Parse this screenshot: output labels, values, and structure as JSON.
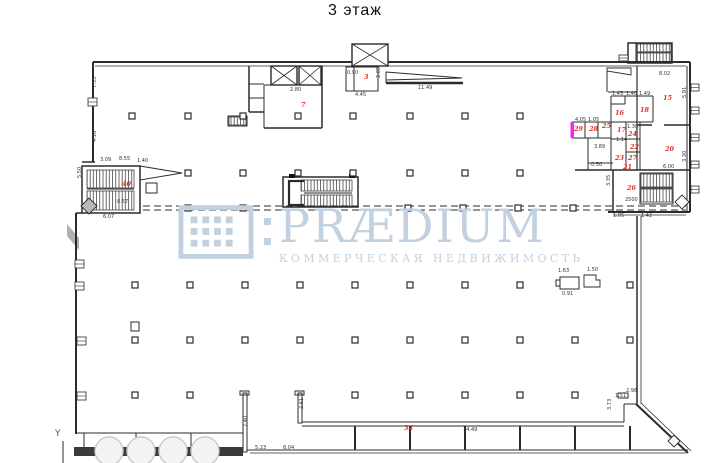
{
  "title": "3 этаж",
  "watermark": {
    "brand": "PRÆDIUM",
    "subtitle": "КОММЕРЧЕСКАЯ НЕДВИЖИМОСТЬ",
    "color": "#c2d1e0"
  },
  "plan": {
    "colors": {
      "line": "#2b2b2b",
      "red": "#e03028",
      "pink": "#ee2ee2",
      "gray": "#b0b0b0",
      "circle_fill": "#f3f3f3",
      "circle_stroke": "#c9c9c9",
      "bar": "#3a3a3a"
    },
    "room_labels": [
      {
        "t": "3",
        "x": 364,
        "y": 79
      },
      {
        "t": "7",
        "x": 301,
        "y": 107
      },
      {
        "t": "40",
        "x": 122,
        "y": 186
      },
      {
        "t": "15",
        "x": 663,
        "y": 100
      },
      {
        "t": "16",
        "x": 615,
        "y": 115
      },
      {
        "t": "18",
        "x": 640,
        "y": 112
      },
      {
        "t": "17",
        "x": 617,
        "y": 132
      },
      {
        "t": "24",
        "x": 628,
        "y": 136
      },
      {
        "t": "22",
        "x": 630,
        "y": 149
      },
      {
        "t": "23",
        "x": 615,
        "y": 160
      },
      {
        "t": "27",
        "x": 628,
        "y": 160
      },
      {
        "t": "21",
        "x": 623,
        "y": 169
      },
      {
        "t": "25",
        "x": 602,
        "y": 128
      },
      {
        "t": "28",
        "x": 589,
        "y": 131
      },
      {
        "t": "29",
        "x": 574,
        "y": 131
      },
      {
        "t": "20",
        "x": 665,
        "y": 151
      },
      {
        "t": "26",
        "x": 627,
        "y": 190
      },
      {
        "t": "34",
        "x": 404,
        "y": 430
      }
    ],
    "dims": [
      {
        "t": "7.35",
        "x": 96,
        "y": 88,
        "r": 1
      },
      {
        "t": "4.16",
        "x": 96,
        "y": 142,
        "r": 1
      },
      {
        "t": "3.09",
        "x": 100,
        "y": 161
      },
      {
        "t": "8.55",
        "x": 119,
        "y": 160
      },
      {
        "t": "1.40",
        "x": 137,
        "y": 162
      },
      {
        "t": "5.50",
        "x": 81,
        "y": 178,
        "r": 1
      },
      {
        "t": "8.57",
        "x": 117,
        "y": 203
      },
      {
        "t": "6.07",
        "x": 103,
        "y": 218
      },
      {
        "t": "2.80",
        "x": 290,
        "y": 91
      },
      {
        "t": "0.90",
        "x": 347,
        "y": 74
      },
      {
        "t": "2.05",
        "x": 380,
        "y": 78,
        "r": 1
      },
      {
        "t": "4.45",
        "x": 355,
        "y": 96
      },
      {
        "t": "11.49",
        "x": 418,
        "y": 89
      },
      {
        "t": "8.02",
        "x": 659,
        "y": 75
      },
      {
        "t": "5.91",
        "x": 686,
        "y": 98,
        "r": 1
      },
      {
        "t": "6.00",
        "x": 663,
        "y": 168
      },
      {
        "t": "3.30",
        "x": 686,
        "y": 162,
        "r": 1
      },
      {
        "t": "4.05",
        "x": 575,
        "y": 121
      },
      {
        "t": "1.05",
        "x": 588,
        "y": 121
      },
      {
        "t": "1.43",
        "x": 612,
        "y": 95
      },
      {
        "t": "1.40",
        "x": 626,
        "y": 95
      },
      {
        "t": "1.49",
        "x": 639,
        "y": 95
      },
      {
        "t": "3.89",
        "x": 594,
        "y": 148
      },
      {
        "t": "1.14",
        "x": 616,
        "y": 141
      },
      {
        "t": "1.30",
        "x": 627,
        "y": 128
      },
      {
        "t": "0.50",
        "x": 591,
        "y": 166
      },
      {
        "t": "3.35",
        "x": 610,
        "y": 186,
        "r": 1
      },
      {
        "t": "2500",
        "x": 625,
        "y": 201
      },
      {
        "t": "1.05",
        "x": 613,
        "y": 217
      },
      {
        "t": "1.42",
        "x": 641,
        "y": 217
      },
      {
        "t": "1.63",
        "x": 558,
        "y": 272
      },
      {
        "t": "1.50",
        "x": 587,
        "y": 271
      },
      {
        "t": "0.91",
        "x": 562,
        "y": 295
      },
      {
        "t": "7.40",
        "x": 247,
        "y": 427,
        "r": 1
      },
      {
        "t": "2.61",
        "x": 303,
        "y": 409,
        "r": 1
      },
      {
        "t": "5.23",
        "x": 255,
        "y": 449
      },
      {
        "t": "8.04",
        "x": 283,
        "y": 449
      },
      {
        "t": "14.49",
        "x": 463,
        "y": 431
      },
      {
        "t": "1.51",
        "x": 615,
        "y": 397
      },
      {
        "t": "2.98",
        "x": 626,
        "y": 392
      },
      {
        "t": "3.73",
        "x": 611,
        "y": 410,
        "r": 1
      }
    ],
    "texts": [
      {
        "t": "Y",
        "x": 55,
        "y": 436
      }
    ],
    "geometry": {
      "walls": [
        [
          93,
          62,
          690,
          62,
          2
        ],
        [
          95,
          66,
          686,
          66,
          0.8
        ],
        [
          93,
          62,
          93,
          162,
          2
        ],
        [
          687,
          66,
          687,
          212,
          1
        ],
        [
          690,
          62,
          690,
          212,
          2
        ],
        [
          82,
          162,
          95,
          162,
          1.5
        ],
        [
          76,
          213,
          76,
          434,
          2
        ],
        [
          76,
          213,
          82,
          213,
          1.5
        ],
        [
          76,
          433,
          243,
          433,
          1
        ],
        [
          84,
          433,
          84,
          447,
          1
        ],
        [
          136,
          433,
          136,
          447,
          1
        ],
        [
          191,
          433,
          191,
          447,
          1
        ],
        [
          63,
          441,
          63,
          463,
          1
        ],
        [
          608,
          212,
          690,
          212,
          2
        ],
        [
          613,
          215,
          686,
          215,
          0.8
        ],
        [
          637,
          216,
          637,
          404,
          1.5
        ],
        [
          641,
          216,
          641,
          404,
          0.8
        ],
        [
          636,
          404,
          688,
          453,
          2
        ],
        [
          641,
          403,
          691,
          451,
          0.8
        ],
        [
          302,
          422,
          624,
          422,
          1
        ],
        [
          302,
          426,
          624,
          426,
          1
        ],
        [
          247,
          450,
          688,
          450,
          1
        ],
        [
          250,
          453,
          686,
          453,
          0.8
        ],
        [
          355,
          426,
          355,
          450,
          2
        ],
        [
          410,
          426,
          410,
          450,
          2
        ],
        [
          465,
          426,
          465,
          450,
          2
        ],
        [
          520,
          426,
          520,
          450,
          2
        ],
        [
          575,
          426,
          575,
          450,
          2
        ],
        [
          630,
          426,
          630,
          450,
          2
        ],
        [
          624,
          404,
          624,
          422,
          1
        ],
        [
          624,
          404,
          637,
          404,
          1
        ],
        [
          607,
          71,
          607,
          92,
          1
        ],
        [
          608,
          92,
          637,
          92,
          1
        ],
        [
          611,
          96,
          611,
          170,
          1
        ],
        [
          611,
          96,
          653,
          96,
          1
        ],
        [
          637,
          66,
          637,
          170,
          1.2
        ],
        [
          653,
          96,
          653,
          122,
          1
        ],
        [
          611,
          104,
          625,
          104,
          1
        ],
        [
          625,
          96,
          625,
          104,
          1
        ],
        [
          611,
          122,
          653,
          122,
          1
        ],
        [
          626,
          122,
          626,
          170,
          1
        ],
        [
          611,
          139,
          640,
          139,
          1
        ],
        [
          640,
          122,
          640,
          170,
          1
        ],
        [
          626,
          152,
          640,
          152,
          1
        ],
        [
          575,
          170,
          690,
          170,
          1.5
        ],
        [
          588,
          138,
          588,
          170,
          1
        ],
        [
          572,
          122,
          611,
          122,
          1
        ],
        [
          572,
          138,
          611,
          138,
          1
        ],
        [
          585,
          122,
          585,
          138,
          1
        ],
        [
          598,
          122,
          598,
          138,
          1
        ],
        [
          572,
          122,
          572,
          138,
          0.8
        ],
        [
          588,
          163,
          613,
          163,
          1
        ],
        [
          637,
          125,
          652,
          125,
          1.5
        ],
        [
          664,
          125,
          690,
          125,
          1.5
        ],
        [
          613,
          170,
          613,
          212,
          1.5
        ],
        [
          640,
          188,
          673,
          188,
          1
        ],
        [
          87,
          189,
          134,
          189,
          1
        ],
        [
          249,
          66,
          249,
          112,
          1.5
        ],
        [
          249,
          112,
          264,
          112,
          1.5
        ],
        [
          264,
          85,
          264,
          128,
          1
        ],
        [
          264,
          128,
          322,
          128,
          1.5
        ],
        [
          322,
          66,
          322,
          128,
          1.5
        ],
        [
          249,
          84,
          264,
          84,
          1
        ],
        [
          249,
          98,
          264,
          98,
          1
        ],
        [
          264,
          85,
          322,
          85,
          1
        ],
        [
          354,
          67,
          354,
          91,
          1
        ],
        [
          304,
          181,
          289,
          181,
          2.2
        ],
        [
          289,
          180,
          289,
          206,
          2.2
        ],
        [
          289,
          205,
          304,
          205,
          2.2
        ],
        [
          304,
          193,
          352,
          193,
          1
        ],
        [
          386,
          83,
          463,
          83,
          2.5
        ],
        [
          386,
          72,
          386,
          83,
          1
        ],
        [
          637,
          52,
          671,
          52,
          1
        ]
      ],
      "rects": [
        [
          82,
          166,
          58,
          47,
          1.5
        ],
        [
          146,
          183,
          11,
          10,
          1
        ],
        [
          228,
          116,
          19,
          10,
          1
        ],
        [
          346,
          67,
          32,
          24,
          1
        ],
        [
          283,
          177,
          75,
          30,
          1.5
        ],
        [
          640,
          173,
          33,
          31,
          1
        ],
        [
          628,
          43,
          44,
          20,
          1.5
        ],
        [
          628,
          43,
          8,
          20,
          1
        ],
        [
          240,
          391,
          9,
          4,
          1
        ],
        [
          295,
          391,
          9,
          4,
          1
        ],
        [
          243,
          393,
          4,
          59,
          1
        ],
        [
          298,
          393,
          4,
          30,
          1
        ],
        [
          618,
          393,
          10,
          5,
          1
        ],
        [
          131,
          322,
          8,
          9,
          1
        ],
        [
          556,
          280,
          4,
          6,
          1
        ],
        [
          560,
          277,
          19,
          12,
          1
        ]
      ],
      "frects": [
        [
          74,
          447,
          169,
          9,
          "#3a3a3a"
        ],
        [
          289,
          174,
          6,
          4,
          "#111"
        ],
        [
          349,
          174,
          6,
          4,
          "#111"
        ],
        [
          570.5,
          122,
          3.5,
          16,
          "#ee2ee2"
        ]
      ],
      "hatches": [
        [
          87,
          170,
          47,
          18
        ],
        [
          87,
          191,
          47,
          19
        ],
        [
          301,
          180,
          51,
          11
        ],
        [
          301,
          195,
          51,
          11
        ],
        [
          641,
          174,
          31,
          13
        ],
        [
          641,
          189,
          31,
          13
        ],
        [
          637,
          44,
          34,
          8
        ],
        [
          637,
          53,
          34,
          9
        ],
        [
          229,
          117,
          17,
          8
        ]
      ],
      "xboxes": [
        [
          271,
          66,
          26,
          19
        ],
        [
          299,
          66,
          22,
          19
        ],
        [
          352,
          44,
          36,
          22
        ]
      ],
      "polys": [
        {
          "pts": "140,166 182,173 140,180",
          "fill": "#fff"
        },
        {
          "pts": "386,72 462,78 386,80",
          "fill": "#fff"
        },
        {
          "pts": "67,224 79,238 79,250 67,236",
          "fill": "#b0b0b0",
          "stroke": 0
        },
        {
          "pts": "607,68 631,68 631,75 607,71",
          "fill": "#fff"
        },
        {
          "pts": "584,275 596,275 596,280 600,280 600,287 584,287",
          "fill": "#fff"
        }
      ],
      "dashes": [
        [
          143,
          206,
          686,
          206
        ],
        [
          143,
          210,
          686,
          210
        ]
      ],
      "columns": [
        [
          132,
          116
        ],
        [
          188,
          116
        ],
        [
          243,
          116
        ],
        [
          298,
          116
        ],
        [
          353,
          116
        ],
        [
          410,
          116
        ],
        [
          465,
          116
        ],
        [
          520,
          116
        ],
        [
          188,
          173
        ],
        [
          243,
          173
        ],
        [
          298,
          173
        ],
        [
          353,
          173
        ],
        [
          410,
          173
        ],
        [
          465,
          173
        ],
        [
          520,
          173
        ],
        [
          188,
          208
        ],
        [
          243,
          208
        ],
        [
          408,
          208
        ],
        [
          463,
          208
        ],
        [
          518,
          208
        ],
        [
          573,
          208
        ],
        [
          135,
          285
        ],
        [
          190,
          285
        ],
        [
          245,
          285
        ],
        [
          300,
          285
        ],
        [
          355,
          285
        ],
        [
          410,
          285
        ],
        [
          465,
          285
        ],
        [
          520,
          285
        ],
        [
          630,
          285
        ],
        [
          135,
          340
        ],
        [
          190,
          340
        ],
        [
          245,
          340
        ],
        [
          300,
          340
        ],
        [
          355,
          340
        ],
        [
          410,
          340
        ],
        [
          465,
          340
        ],
        [
          520,
          340
        ],
        [
          575,
          340
        ],
        [
          630,
          340
        ],
        [
          135,
          395
        ],
        [
          190,
          395
        ],
        [
          355,
          395
        ],
        [
          410,
          395
        ],
        [
          465,
          395
        ],
        [
          520,
          395
        ],
        [
          575,
          395
        ]
      ],
      "circles": [
        [
          109,
          451,
          14
        ],
        [
          141,
          451,
          14
        ],
        [
          173,
          451,
          14
        ],
        [
          205,
          451,
          14
        ]
      ],
      "diamonds": [
        [
          89,
          206,
          8,
          "#b8b8b8"
        ],
        [
          682,
          202,
          7,
          "#ffffff"
        ],
        [
          674,
          441,
          6,
          "#ffffff"
        ]
      ],
      "windows": [
        [
          691,
          84,
          8,
          7
        ],
        [
          691,
          107,
          8,
          7
        ],
        [
          691,
          134,
          8,
          7
        ],
        [
          691,
          161,
          8,
          7
        ],
        [
          691,
          186,
          8,
          7
        ],
        [
          75,
          260,
          9,
          8
        ],
        [
          75,
          282,
          9,
          8
        ],
        [
          77,
          337,
          9,
          8
        ],
        [
          77,
          392,
          9,
          8
        ],
        [
          88,
          98,
          9,
          8
        ],
        [
          619,
          55,
          9,
          6
        ]
      ]
    }
  }
}
